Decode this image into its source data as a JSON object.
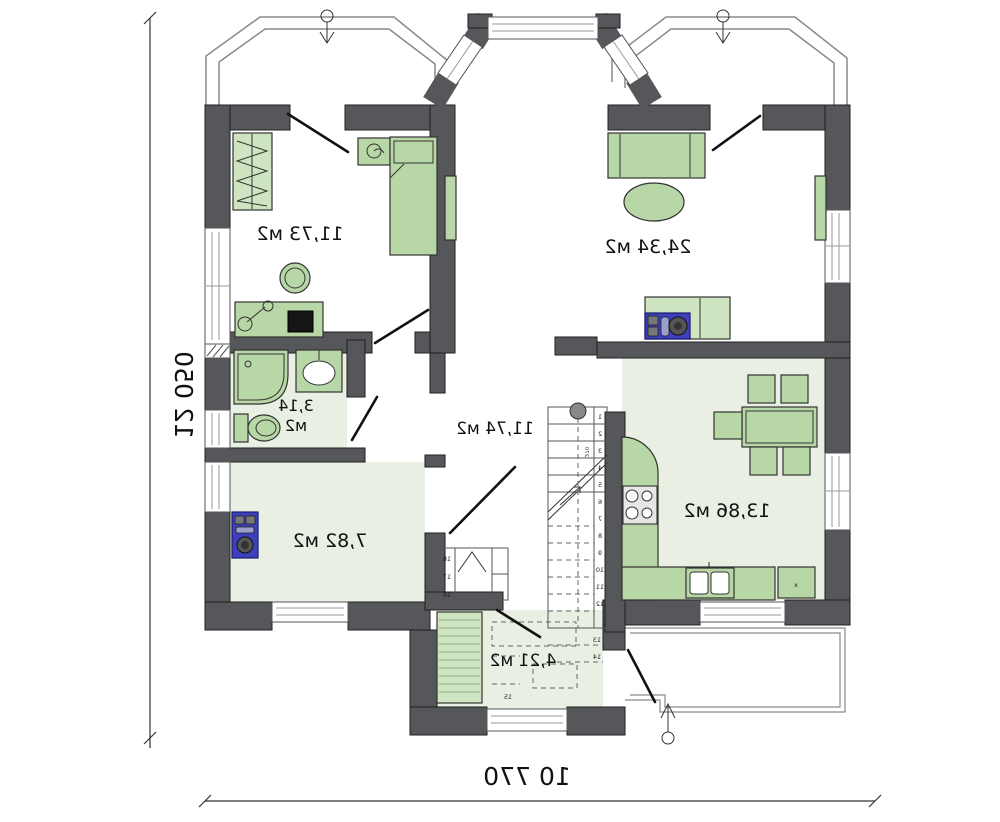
{
  "plan": {
    "type": "floor-plan",
    "mirrored": true,
    "dimensions": {
      "left_vertical": "12 050",
      "bottom_horizontal": "10 770"
    },
    "rooms": {
      "bedroom1": {
        "area": "11,73 м2"
      },
      "living": {
        "area": "24,34 м2"
      },
      "bathroom": {
        "area_line1": "3,14",
        "area_line2": "м2"
      },
      "hall": {
        "area": "11,74 м2"
      },
      "storage": {
        "area": "7,82 м2"
      },
      "kitchen": {
        "area": "13,86 м2",
        "appliance_mark": "x"
      },
      "entry": {
        "area": "4,21 м2"
      }
    },
    "stairs": {
      "step_numbers": [
        "1",
        "2",
        "3",
        "4",
        "5",
        "6",
        "7",
        "8",
        "9",
        "10",
        "11",
        "12",
        "13",
        "14"
      ],
      "landing_step": "15",
      "riser_note": "270",
      "closet_shelf_numbers": [
        "18",
        "17",
        "16"
      ]
    },
    "colors": {
      "wall": "#55575a",
      "floor_green": "#e9efe2",
      "furniture_green": "#b8d7a6",
      "furniture_light_green": "#cfe4c0",
      "appliance_blue": "#3d3fbe",
      "outline": "#2a2a2a"
    }
  }
}
